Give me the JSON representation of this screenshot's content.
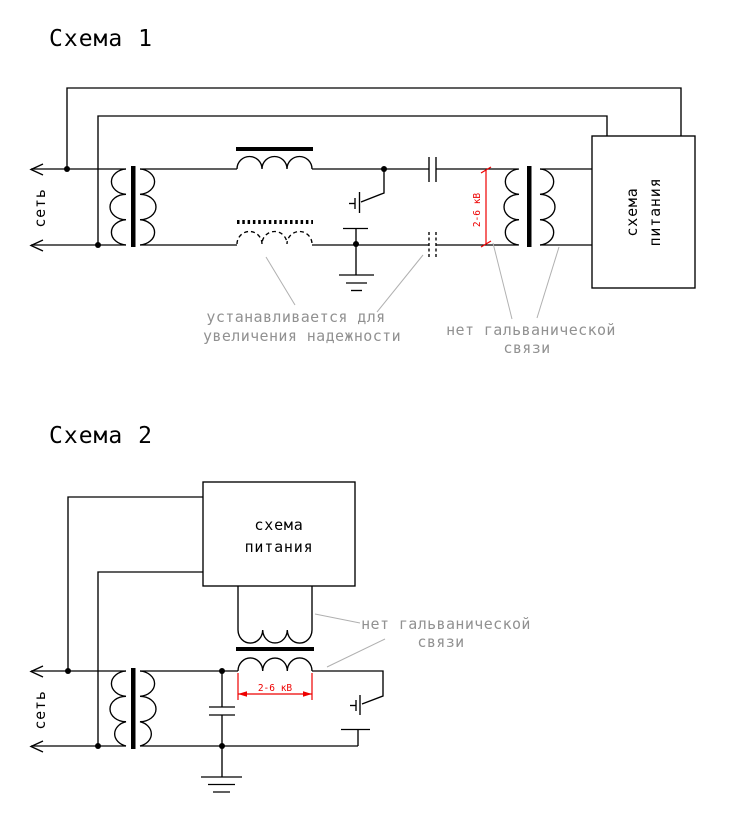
{
  "colors": {
    "background": "#ffffff",
    "line": "#000000",
    "annotation_text": "#919191",
    "leader_line": "#b0b0b0",
    "dimension_red": "#ee0000"
  },
  "schema1": {
    "title": "Схема 1",
    "mains_label": "сеть",
    "power_box": {
      "line1": "схема",
      "line2": "питания"
    },
    "voltage_label": "2-6 кВ",
    "notes": {
      "reliability_line1": "устанавливается для",
      "reliability_line2": "увеличения надежности",
      "isolation_line1": "нет гальванической",
      "isolation_line2": "связи"
    }
  },
  "schema2": {
    "title": "Схема 2",
    "mains_label": "сеть",
    "power_box": {
      "line1": "схема",
      "line2": "питания"
    },
    "voltage_label": "2-6 кВ",
    "notes": {
      "isolation_line1": "нет гальванической",
      "isolation_line2": "связи"
    }
  }
}
